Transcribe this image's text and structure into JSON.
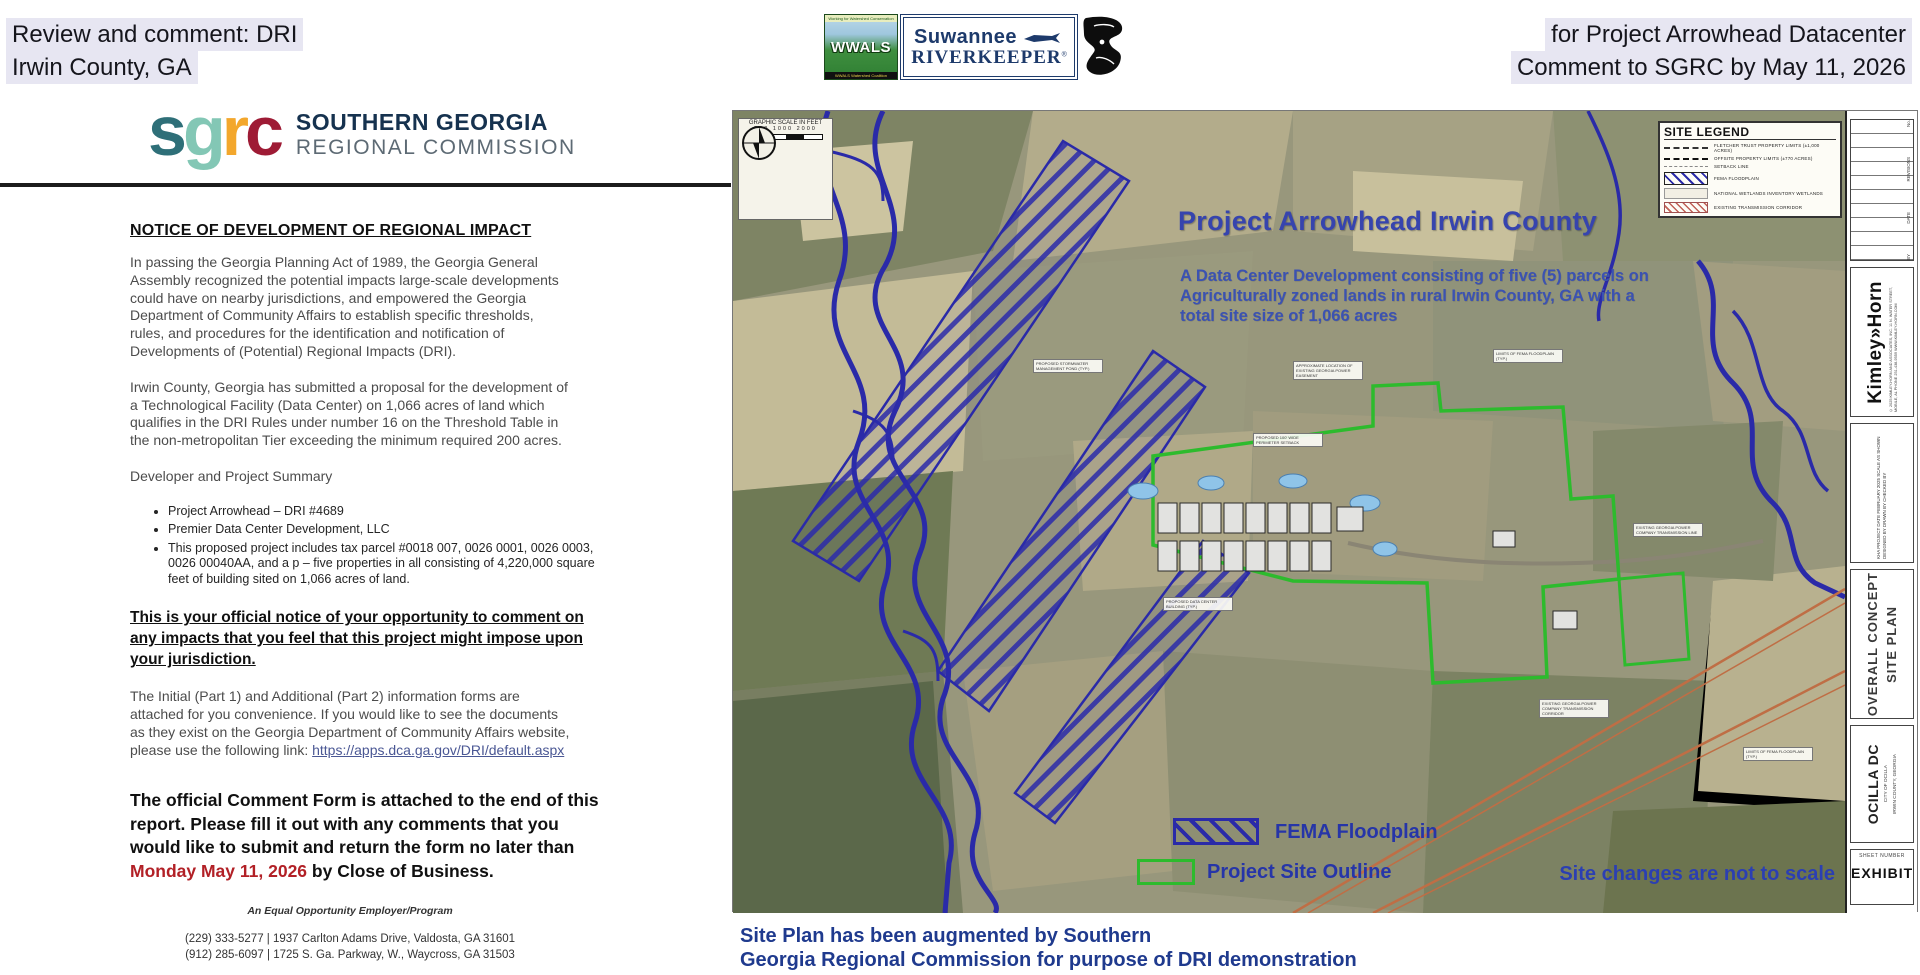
{
  "header": {
    "left1": "Review and comment: DRI",
    "left2": "Irwin County, GA",
    "right1": "for Project Arrowhead Datacenter",
    "right2": "Comment to SGRC by May 11, 2026",
    "logos": {
      "wwals_banner": "Working for Watershed Conservation",
      "wwals_name": "WWALS",
      "wwals_footer": "WWALS Watershed Coalition",
      "rk_line1": "Suwannee",
      "rk_line2": "RIVERKEEPER",
      "rk_reg": "®"
    }
  },
  "letterhead": {
    "s": "s",
    "g": "g",
    "r": "r",
    "c": "c",
    "org1": "SOUTHERN GEORGIA",
    "org2": "REGIONAL COMMISSION"
  },
  "notice": {
    "heading": "NOTICE OF DEVELOPMENT OF REGIONAL IMPACT",
    "para1": "In passing the Georgia Planning Act of 1989, the Georgia General Assembly recognized the potential impacts large-scale developments could have on nearby jurisdictions, and empowered the Georgia Department of Community Affairs to establish specific thresholds, rules, and procedures for the identification and notification of Developments of (Potential) Regional Impacts (DRI).",
    "para2": "Irwin County, Georgia has submitted a proposal for the development of a Technological Facility (Data Center) on 1,066 acres of land which qualifies in the DRI Rules under number 16 on the Threshold Table in the non-metropolitan Tier exceeding the minimum required 200 acres.",
    "summary_heading": "Developer and Project Summary",
    "bullets": [
      "Project Arrowhead – DRI #4689",
      "Premier Data Center Development, LLC",
      "This proposed project includes tax parcel #0018 007, 0026 0001, 0026 0003, 0026 00040AA, and a p – five properties in all consisting of 4,220,000 square feet of building sited on 1,066 acres of land."
    ],
    "official_notice": "This is your official notice of your opportunity to comment on any impacts that you feel that this project might impose upon your jurisdiction.",
    "forms_text": "The Initial (Part 1) and Additional (Part 2) information forms are attached for you convenience.  If you would like to see the documents as they exist on the Georgia Department of Community Affairs website, please use the following link:  ",
    "forms_link": "https://apps.dca.ga.gov/DRI/default.aspx",
    "comment_before": "The official Comment Form is attached to the end of this report.  Please fill it out with any comments that you would like to submit and return the form no later than ",
    "comment_date": "Monday May 11, 2026",
    "comment_after": " by Close of Business.",
    "eoe": "An Equal Opportunity Employer/Program",
    "contact1": "(229) 333-5277  |  1937 Carlton Adams Drive, Valdosta, GA 31601",
    "contact2": "(912) 285-6097  |  1725 S. Ga. Parkway, W., Waycross, GA 31503",
    "website": "http://www.sgrc.us"
  },
  "map": {
    "title": "Project Arrowhead Irwin County",
    "subtitle": "A Data Center Development consisting of five (5) parcels on Agriculturally zoned lands in rural Irwin County, GA with a total site size of 1,066 acres",
    "scale_label": "GRAPHIC SCALE IN FEET",
    "scale_ticks": "500  1000    2000",
    "site_legend": {
      "title": "SITE LEGEND",
      "items": [
        "FLETCHER TRUST PROPERTY LIMITS (±1,000 ACRES)",
        "OFFSITE PROPERTY LIMITS (±770 ACRES)",
        "SETBACK LINE",
        "FEMA FLOODPLAIN",
        "NATIONAL WETLANDS INVENTORY WETLANDS",
        "EXISTING TRANSMISSION CORRIDOR"
      ]
    },
    "labels": [
      "PROPOSED STORMWATER MANAGEMENT POND (TYP.)",
      "APPROXIMATE LOCATION OF EXISTING GEORGIA POWER EASEMENT",
      "LIMITS OF FEMA FLOODPLAIN (TYP.)",
      "PROPOSED 100' WIDE PERIMETER SETBACK",
      "EXISTING GEORGIA POWER COMPANY TRANSMISSION LINE",
      "PROPOSED DATA CENTER BUILDING (TYP.)",
      "EXISTING GEORGIA POWER COMPANY TRANSMISSION CORRIDOR",
      "LIMITS OF FEMA FLOODPLAIN (TYP.)"
    ],
    "legend_fema": "FEMA Floodplain",
    "legend_site": "Project Site Outline",
    "not_to_scale": "Site changes are not to scale",
    "caption1": "Site Plan has been augmented by Southern",
    "caption2": "Georgia Regional Commission for purpose of DRI demonstration"
  },
  "titleblock": {
    "no_label": "No.",
    "revisions_label": "REVISIONS",
    "date_label": "DATE",
    "by_label": "BY",
    "firm": "Kimley»Horn",
    "firm_sub": "© 2025 KIMLEY-HORN AND ASSOCIATES, INC.  11 N. WATER STREET, MOBILE, AL  PHONE 251-438-9559  WWW.KIMLEY-HORN.COM",
    "fields": "KHA PROJECT   DATE FEBRUARY 2025   SCALE AS SHOWN   DESIGNED BY   DRAWN BY   CHECKED BY",
    "sheet_title1": "OVERALL CONCEPT",
    "sheet_title2": "SITE  PLAN",
    "project": "OCILLA DC",
    "project_sub1": "CITY OF OCILLA",
    "project_sub2": "IRWIN COUNTY, GEORGIA",
    "sheet_number_label": "SHEET NUMBER",
    "sheet_number": "EXHIBIT"
  },
  "colors": {
    "highlight": "#e7e6f2",
    "map_title_blue": "#3644ae",
    "floodplain_blue": "#2a2aa8",
    "site_green": "#2dbb2d",
    "caption_blue": "#1f3a8e",
    "date_red": "#b22026",
    "sgrc_teal": "#2e6f78",
    "sgrc_seafoam": "#83c7b5",
    "sgrc_amber": "#f3a72c",
    "sgrc_crimson": "#9e1b35"
  }
}
